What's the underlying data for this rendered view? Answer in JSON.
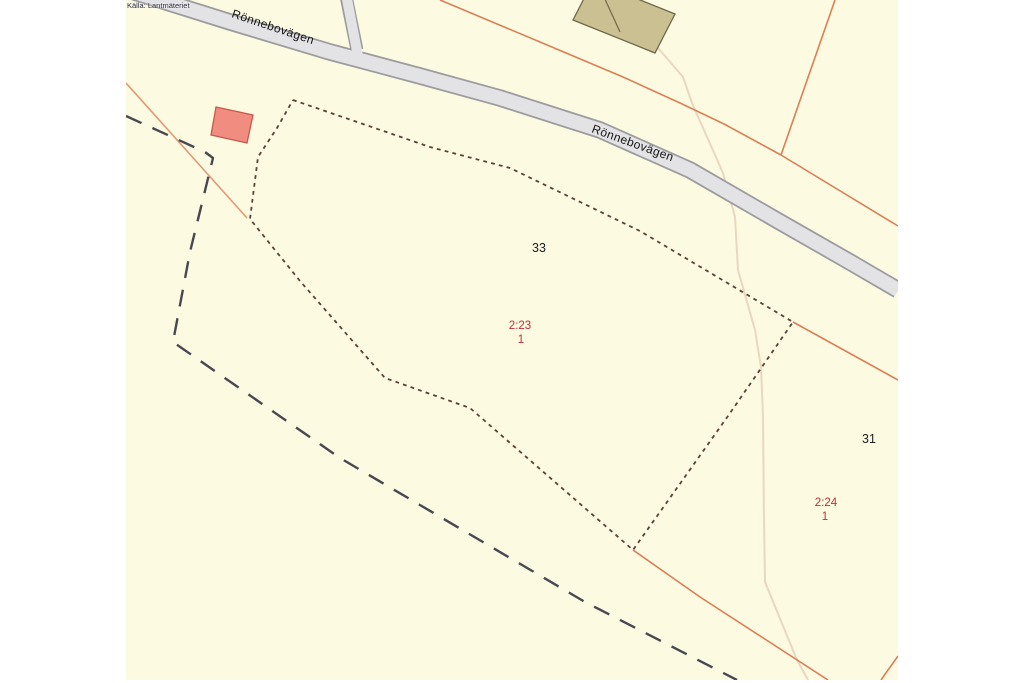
{
  "source_note": "Källa: Lantmäteriet",
  "map": {
    "area": {
      "x": 126,
      "y": 0,
      "width": 772,
      "height": 680
    },
    "colors": {
      "land": "#fdfae2",
      "frame": "#ffffff",
      "road_fill": "#e3e3e6",
      "road_casing": "#9c9c9e",
      "boundary_orange": "#db7f55",
      "boundary_orange_light": "#e39a74",
      "cadastral_dotted": "#5a413a",
      "survey_dashed": "#484851",
      "trail": "#e9d7bf",
      "building_tan": "#cbc092",
      "building_tan_stroke": "#6f684a",
      "building_salmon": "#f08d80",
      "building_salmon_stroke": "#c6594b",
      "label_black": "#1d1d1d",
      "label_red": "#c22f38",
      "road_label": "#141414"
    },
    "features": [
      {
        "kind": "path",
        "name": "trail-line",
        "d": "M 658,48 L 683,77 L 692,103 L 723,173 L 735,217 L 738,270 L 755,330 L 761,367 L 763,417 L 764,520 L 765,582 L 797,660 L 808,680",
        "stroke": "#e9d7bf",
        "width": 2,
        "cap": "round"
      },
      {
        "kind": "path",
        "name": "road-casing",
        "d": "M 128,-10 L 230,22 L 330,52 L 420,76 L 500,98 L 600,130 L 690,170 L 780,222 L 850,262 L 898,290",
        "stroke": "#9c9c9e",
        "width": 17.5
      },
      {
        "kind": "path",
        "name": "branch-road-casing",
        "d": "M 346,-4 L 357,50",
        "stroke": "#9c9c9e",
        "width": 13
      },
      {
        "kind": "path",
        "name": "road-fill",
        "d": "M 128,-10 L 230,22 L 330,52 L 420,76 L 500,98 L 600,130 L 690,170 L 780,222 L 850,262 L 898,290",
        "stroke": "#e3e3e6",
        "width": 14
      },
      {
        "kind": "path",
        "name": "branch-road-fill",
        "d": "M 346,-6 L 358,56",
        "stroke": "#e3e3e6",
        "width": 10
      },
      {
        "kind": "path",
        "name": "boundary-line-west",
        "d": "M 126,83 L 247,218",
        "stroke": "#e39a74",
        "width": 1.6
      },
      {
        "kind": "path",
        "name": "boundary-line-north",
        "d": "M 440,0 L 540,42 L 623,77 L 680,103 L 724,124 L 781,155",
        "stroke": "#db7f55",
        "width": 1.6
      },
      {
        "kind": "path",
        "name": "boundary-line-northeast",
        "d": "M 835,0 L 781,155",
        "stroke": "#db7f55",
        "width": 1.6
      },
      {
        "kind": "path",
        "name": "boundary-line-east-upper",
        "d": "M 781,155 L 898,226",
        "stroke": "#db7f55",
        "width": 1.6
      },
      {
        "kind": "path",
        "name": "boundary-line-east-mid",
        "d": "M 793,322 L 898,380",
        "stroke": "#db7f55",
        "width": 1.6
      },
      {
        "kind": "path",
        "name": "boundary-line-southeast",
        "d": "M 633,550 L 700,597 L 828,680",
        "stroke": "#db7f55",
        "width": 1.6
      },
      {
        "kind": "path",
        "name": "boundary-line-corner",
        "d": "M 898,656 L 881,680",
        "stroke": "#db7f55",
        "width": 1.6
      },
      {
        "kind": "path",
        "name": "cadastral-dotted-boundary",
        "d": "M 293,100 L 430,147 L 510,168 L 640,231 L 793,322 L 728,416 L 633,550 L 470,408 L 385,378 L 300,281 L 250,219 L 258,157 L 277,128 L 293,100",
        "stroke": "#5a413a",
        "width": 1.8,
        "dash": "3.8 4.2"
      },
      {
        "kind": "path",
        "name": "survey-dashed-line",
        "d": "M 126,116 L 205,152 L 213,158 L 190,252 L 173,342 L 340,458 L 585,602 L 737,680",
        "stroke": "#484851",
        "width": 2.4,
        "dash": "17 12"
      },
      {
        "kind": "polygon",
        "name": "building-tan",
        "points": "573,20 593,-19 675,14 655,53",
        "fill": "#cbc092",
        "stroke": "#6f684a",
        "width": 1.3
      },
      {
        "kind": "path",
        "name": "building-tan-divider",
        "d": "M 604,-3 L 620,32",
        "stroke": "#6f684a",
        "width": 1.2
      },
      {
        "kind": "polygon",
        "name": "building-salmon",
        "points": "216,107 253,115 247,143 211,135",
        "fill": "#f08d80",
        "stroke": "#c6594b",
        "width": 1.3
      }
    ],
    "labels": [
      {
        "name": "road-label",
        "text": "Rönnebovägen",
        "x": 231,
        "y": 17,
        "rotate": 18.5,
        "size": 12,
        "color": "#141414",
        "anchor": "start",
        "spacing": 0.4
      },
      {
        "name": "road-label",
        "text": "Rönnebovägen",
        "x": 591,
        "y": 132,
        "rotate": 20,
        "size": 12,
        "color": "#141414",
        "anchor": "start",
        "spacing": 0.4
      },
      {
        "name": "parcel-block-label",
        "text": "33",
        "x": 539,
        "y": 252,
        "rotate": 0,
        "size": 12.5,
        "color": "#1d1d1d",
        "anchor": "middle",
        "spacing": 0
      },
      {
        "name": "parcel-number-label",
        "text": "2:23",
        "x": 520,
        "y": 329,
        "rotate": 0,
        "size": 11.5,
        "color": "#c22f38",
        "anchor": "middle",
        "spacing": 0
      },
      {
        "name": "parcel-unit-label",
        "text": "1",
        "x": 521,
        "y": 343,
        "rotate": 0,
        "size": 11.5,
        "color": "#c22f38",
        "anchor": "middle",
        "spacing": 0
      },
      {
        "name": "parcel-block-label",
        "text": "31",
        "x": 869,
        "y": 443,
        "rotate": 0,
        "size": 12.5,
        "color": "#1d1d1d",
        "anchor": "middle",
        "spacing": 0
      },
      {
        "name": "parcel-number-label",
        "text": "2:24",
        "x": 826,
        "y": 506,
        "rotate": 0,
        "size": 11.5,
        "color": "#c22f38",
        "anchor": "middle",
        "spacing": 0
      },
      {
        "name": "parcel-unit-label",
        "text": "1",
        "x": 825,
        "y": 520,
        "rotate": 0,
        "size": 11.5,
        "color": "#c22f38",
        "anchor": "middle",
        "spacing": 0
      }
    ]
  }
}
